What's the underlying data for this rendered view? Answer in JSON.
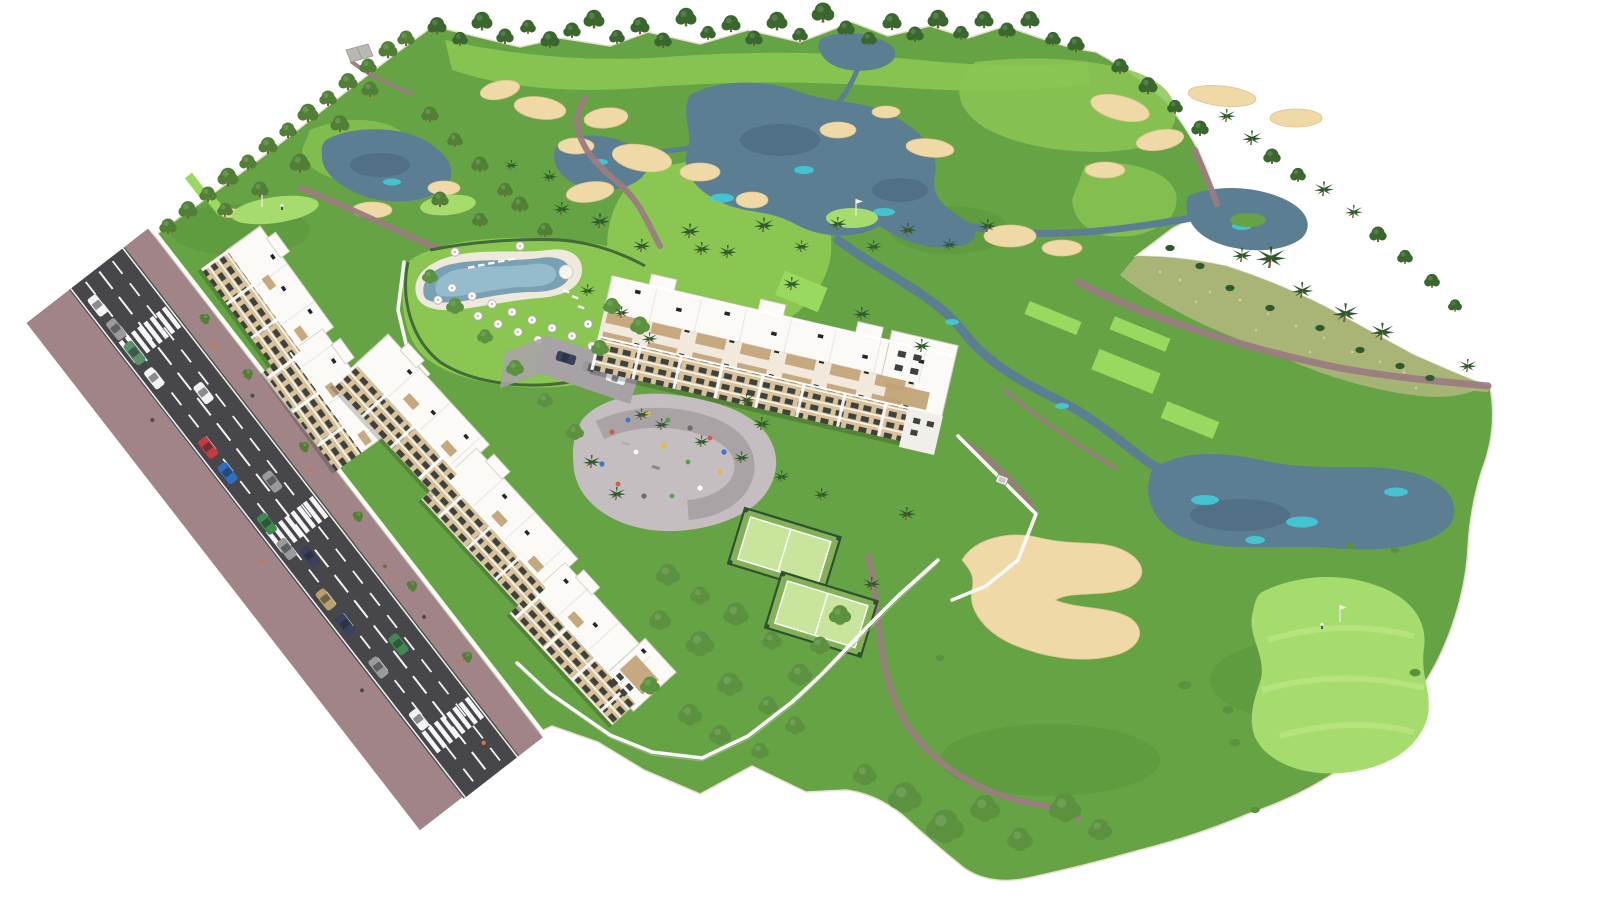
{
  "scene": {
    "type": "architectural-aerial-render",
    "subject": "golf-resort-apartment-development",
    "view": "isometric-aerial"
  },
  "palette": {
    "background": "#ffffff",
    "grass_base": "#66a344",
    "grass_shade": "#4e8a33",
    "fairway": "#8bc653",
    "tee": "#9ad95f",
    "green": "#a6dc6d",
    "green_mow": "#c4ea8f",
    "scrub": "#a8b577",
    "scrub_dot": "#d8cf8f",
    "sand": "#efd9a7",
    "sand_edge": "#dfc48d",
    "pond": "#5c7e92",
    "pond_deep": "#48657b",
    "teal": "#3fd0da",
    "cart_path": "#9b7c81",
    "sidewalk": "#a08487",
    "asphalt": "#46464b",
    "lane_white": "#ffffff",
    "wall": "#fafaf8",
    "roof_white": "#fbfaf7",
    "facade_cream": "#d9c299",
    "pergola_wood": "#c2a276",
    "window_dark": "#3d423e",
    "court_green": "#c9e59d",
    "court_base": "#84b158",
    "court_fence": "#2e5132",
    "play_paving": "#c4bec0",
    "play_band": "#938c90",
    "pool_water": "#7aa0b4",
    "pool_light": "#9cc3d2",
    "pool_deck": "#efe9dd",
    "tree_dark": "#3a672e",
    "tree_mid": "#517f35",
    "tree_lush": "#5c9140",
    "palm": "#2e5a2b",
    "trunk": "#7c5c3c",
    "umbrella_white": "#ffffff",
    "car_white": "#f2f2f2",
    "car_gray": "#9a9a9a",
    "car_red": "#c33b3f",
    "car_blue": "#2e6fc2",
    "car_green": "#3e8a4f",
    "car_tan": "#b9a06b",
    "car_navy": "#39415c",
    "car_truck": "#5d8f6a",
    "people_orange": "#c87748",
    "cart_white": "#f4f4f0"
  },
  "inventory": {
    "apartment_blocks": 4,
    "padel_courts": 2,
    "swimming_pools": 1,
    "playgrounds": 1,
    "crosswalks": 3,
    "golf_flags": 3,
    "golfers": 3,
    "ponds": 7,
    "sand_bunkers": 21,
    "road_cars": 16,
    "parking_lot_cars": 3,
    "golf_carts": 1,
    "pool_umbrellas": 18
  }
}
